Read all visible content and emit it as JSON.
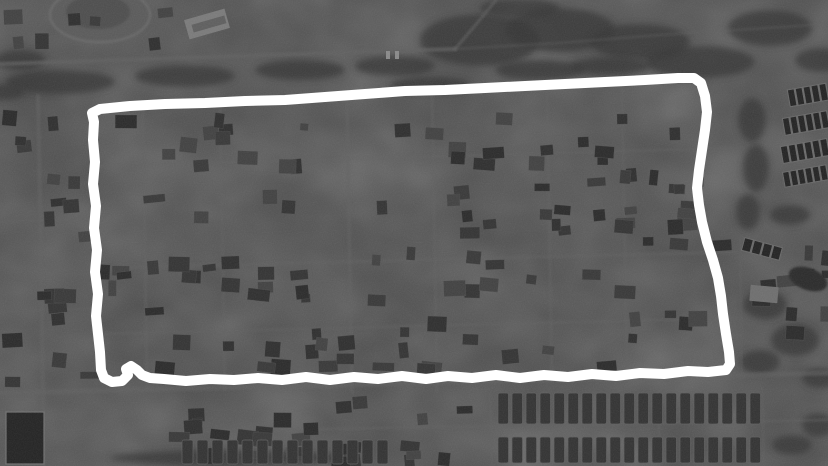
{
  "scene": {
    "kind": "grayscale-satellite-photo",
    "description": "Black-and-white aerial view of a dense low-rise residential district; a thick hand-drawn white marker outline encloses a large rectangular block of houses",
    "width": 828,
    "height": 466,
    "texture_seed": 7,
    "palette": {
      "base": "#4b4b4b",
      "ground_light": "#5a5a5a",
      "vegetation": "#363636",
      "road": "#606060",
      "building_dark": "#2e2e2e",
      "building_mid": "#383838",
      "building_light": "#6e6e6e",
      "water_dark": "#232323",
      "annotation": "#ffffff"
    }
  },
  "annotation": {
    "label": "hand-drawn-outline",
    "color": "#ffffff",
    "stroke_width": 10,
    "closed": true,
    "points": [
      [
        92,
        113
      ],
      [
        100,
        109
      ],
      [
        130,
        106
      ],
      [
        165,
        104
      ],
      [
        205,
        103
      ],
      [
        245,
        101
      ],
      [
        285,
        100
      ],
      [
        325,
        97
      ],
      [
        365,
        94
      ],
      [
        405,
        91
      ],
      [
        445,
        90
      ],
      [
        485,
        88
      ],
      [
        525,
        86
      ],
      [
        565,
        84
      ],
      [
        605,
        82
      ],
      [
        645,
        80
      ],
      [
        678,
        78
      ],
      [
        694,
        78
      ],
      [
        701,
        83
      ],
      [
        705,
        96
      ],
      [
        707,
        112
      ],
      [
        705,
        130
      ],
      [
        702,
        150
      ],
      [
        699,
        170
      ],
      [
        697,
        188
      ],
      [
        699,
        205
      ],
      [
        702,
        222
      ],
      [
        707,
        242
      ],
      [
        713,
        260
      ],
      [
        718,
        278
      ],
      [
        721,
        296
      ],
      [
        723,
        314
      ],
      [
        726,
        334
      ],
      [
        729,
        352
      ],
      [
        730,
        364
      ],
      [
        726,
        370
      ],
      [
        708,
        372
      ],
      [
        688,
        371
      ],
      [
        664,
        374
      ],
      [
        640,
        373
      ],
      [
        616,
        376
      ],
      [
        592,
        374
      ],
      [
        568,
        377
      ],
      [
        544,
        375
      ],
      [
        520,
        378
      ],
      [
        496,
        375
      ],
      [
        472,
        378
      ],
      [
        448,
        376
      ],
      [
        426,
        379
      ],
      [
        402,
        376
      ],
      [
        378,
        379
      ],
      [
        354,
        377
      ],
      [
        330,
        380
      ],
      [
        306,
        377
      ],
      [
        282,
        380
      ],
      [
        258,
        378
      ],
      [
        234,
        380
      ],
      [
        210,
        379
      ],
      [
        186,
        381
      ],
      [
        164,
        379
      ],
      [
        150,
        378
      ],
      [
        142,
        375
      ],
      [
        137,
        370
      ],
      [
        131,
        366
      ],
      [
        126,
        369
      ],
      [
        128,
        375
      ],
      [
        122,
        381
      ],
      [
        112,
        382
      ],
      [
        104,
        378
      ],
      [
        101,
        370
      ],
      [
        100,
        352
      ],
      [
        98,
        334
      ],
      [
        96,
        316
      ],
      [
        98,
        294
      ],
      [
        95,
        272
      ],
      [
        97,
        250
      ],
      [
        94,
        228
      ],
      [
        96,
        206
      ],
      [
        93,
        184
      ],
      [
        95,
        162
      ],
      [
        93,
        140
      ],
      [
        94,
        122
      ]
    ]
  },
  "features": {
    "ground_patches": [
      {
        "cx": 660,
        "cy": 16,
        "rx": 48,
        "ry": 17,
        "o": 0.55
      },
      {
        "cx": 205,
        "cy": 237,
        "rx": 46,
        "ry": 18,
        "o": 0.5
      },
      {
        "cx": 590,
        "cy": 196,
        "rx": 46,
        "ry": 20,
        "o": 0.5
      },
      {
        "cx": 470,
        "cy": 130,
        "rx": 40,
        "ry": 15,
        "o": 0.45
      },
      {
        "cx": 300,
        "cy": 310,
        "rx": 40,
        "ry": 14,
        "o": 0.45
      },
      {
        "cx": 650,
        "cy": 300,
        "rx": 35,
        "ry": 12,
        "o": 0.4
      },
      {
        "cx": 160,
        "cy": 140,
        "rx": 30,
        "ry": 10,
        "o": 0.4
      },
      {
        "cx": 520,
        "cy": 300,
        "rx": 35,
        "ry": 12,
        "o": 0.4
      },
      {
        "cx": 420,
        "cy": 222,
        "rx": 30,
        "ry": 12,
        "o": 0.4
      },
      {
        "cx": 680,
        "cy": 130,
        "rx": 30,
        "ry": 12,
        "o": 0.4
      },
      {
        "cx": 250,
        "cy": 60,
        "rx": 60,
        "ry": 10,
        "o": 0.35
      },
      {
        "cx": 790,
        "cy": 250,
        "rx": 30,
        "ry": 20,
        "o": 0.35
      }
    ],
    "oval_field": {
      "cx": 100,
      "cy": 15,
      "rx": 50,
      "ry": 27,
      "inner_rx": 32,
      "inner_ry": 17
    },
    "vegetation": [
      {
        "cx": 60,
        "cy": 82,
        "rx": 55,
        "ry": 12
      },
      {
        "cx": 185,
        "cy": 76,
        "rx": 50,
        "ry": 11
      },
      {
        "cx": 300,
        "cy": 70,
        "rx": 45,
        "ry": 10
      },
      {
        "cx": 395,
        "cy": 66,
        "rx": 40,
        "ry": 10
      },
      {
        "cx": 480,
        "cy": 40,
        "rx": 60,
        "ry": 26
      },
      {
        "cx": 560,
        "cy": 30,
        "rx": 55,
        "ry": 22
      },
      {
        "cx": 640,
        "cy": 42,
        "rx": 50,
        "ry": 18
      },
      {
        "cx": 700,
        "cy": 62,
        "rx": 55,
        "ry": 16
      },
      {
        "cx": 770,
        "cy": 28,
        "rx": 42,
        "ry": 18
      },
      {
        "cx": 820,
        "cy": 60,
        "rx": 25,
        "ry": 12
      },
      {
        "cx": 430,
        "cy": 85,
        "rx": 40,
        "ry": 8
      },
      {
        "cx": 540,
        "cy": 70,
        "rx": 45,
        "ry": 10
      },
      {
        "cx": 610,
        "cy": 66,
        "rx": 40,
        "ry": 9
      },
      {
        "cx": 752,
        "cy": 120,
        "rx": 14,
        "ry": 22
      },
      {
        "cx": 756,
        "cy": 168,
        "rx": 13,
        "ry": 24
      },
      {
        "cx": 748,
        "cy": 212,
        "rx": 12,
        "ry": 18
      },
      {
        "cx": 790,
        "cy": 215,
        "rx": 20,
        "ry": 10
      },
      {
        "cx": 765,
        "cy": 305,
        "rx": 22,
        "ry": 14
      },
      {
        "cx": 795,
        "cy": 340,
        "rx": 24,
        "ry": 16
      },
      {
        "cx": 760,
        "cy": 362,
        "rx": 20,
        "ry": 12
      },
      {
        "cx": 820,
        "cy": 378,
        "rx": 18,
        "ry": 10
      },
      {
        "cx": 20,
        "cy": 60,
        "rx": 25,
        "ry": 10
      },
      {
        "cx": 5,
        "cy": 92,
        "rx": 20,
        "ry": 8
      },
      {
        "cx": 818,
        "cy": 425,
        "rx": 16,
        "ry": 12
      },
      {
        "cx": 792,
        "cy": 445,
        "rx": 20,
        "ry": 10
      },
      {
        "cx": 230,
        "cy": 458,
        "rx": 120,
        "ry": 8
      },
      {
        "cx": 520,
        "cy": 8,
        "rx": 40,
        "ry": 10
      }
    ],
    "roads": [
      {
        "pts": [
          [
            0,
            64
          ],
          [
            120,
            60
          ],
          [
            240,
            56
          ],
          [
            360,
            52
          ],
          [
            455,
            49
          ]
        ],
        "w": 4,
        "o": 0.7
      },
      {
        "pts": [
          [
            455,
            49
          ],
          [
            478,
            22
          ],
          [
            496,
            0
          ]
        ],
        "w": 3,
        "o": 0.6
      },
      {
        "pts": [
          [
            455,
            49
          ],
          [
            560,
            43
          ],
          [
            660,
            35
          ],
          [
            828,
            24
          ]
        ],
        "w": 3,
        "o": 0.3
      },
      {
        "pts": [
          [
            38,
            96
          ],
          [
            41,
            250
          ],
          [
            44,
            466
          ]
        ],
        "w": 4,
        "o": 0.55
      },
      {
        "pts": [
          [
            143,
            112
          ],
          [
            147,
            388
          ]
        ],
        "w": 3,
        "o": 0.45
      },
      {
        "pts": [
          [
            220,
            110
          ],
          [
            225,
            390
          ]
        ],
        "w": 3,
        "o": 0.4
      },
      {
        "pts": [
          [
            347,
            100
          ],
          [
            352,
            392
          ]
        ],
        "w": 3.5,
        "o": 0.5
      },
      {
        "pts": [
          [
            432,
            96
          ],
          [
            437,
            392
          ]
        ],
        "w": 3,
        "o": 0.45
      },
      {
        "pts": [
          [
            547,
            88
          ],
          [
            552,
            382
          ]
        ],
        "w": 3,
        "o": 0.45
      },
      {
        "pts": [
          [
            622,
            84
          ],
          [
            627,
            380
          ]
        ],
        "w": 3,
        "o": 0.4
      },
      {
        "pts": [
          [
            100,
            166
          ],
          [
            732,
            148
          ]
        ],
        "w": 3,
        "o": 0.4
      },
      {
        "pts": [
          [
            100,
            268
          ],
          [
            736,
            252
          ]
        ],
        "w": 3.5,
        "o": 0.45
      },
      {
        "pts": [
          [
            100,
            334
          ],
          [
            736,
            318
          ]
        ],
        "w": 3,
        "o": 0.4
      },
      {
        "pts": [
          [
            0,
            393
          ],
          [
            828,
            373
          ]
        ],
        "w": 5,
        "o": 0.55
      },
      {
        "pts": [
          [
            150,
            432
          ],
          [
            828,
            420
          ]
        ],
        "w": 3,
        "o": 0.45
      },
      {
        "pts": [
          [
            740,
            238
          ],
          [
            742,
            380
          ]
        ],
        "w": 3,
        "o": 0.3
      },
      {
        "pts": [
          [
            490,
            394
          ],
          [
            492,
            466
          ]
        ],
        "w": 3,
        "o": 0.4
      },
      {
        "pts": [
          [
            658,
            390
          ],
          [
            660,
            466
          ]
        ],
        "w": 3,
        "o": 0.4
      },
      {
        "pts": [
          [
            762,
            388
          ],
          [
            764,
            466
          ]
        ],
        "w": 3,
        "o": 0.35
      },
      {
        "pts": [
          [
            0,
            222
          ],
          [
            95,
            218
          ]
        ],
        "w": 3,
        "o": 0.35
      },
      {
        "pts": [
          [
            0,
            312
          ],
          [
            95,
            308
          ]
        ],
        "w": 3,
        "o": 0.3
      }
    ],
    "building_regions": [
      {
        "x": 108,
        "y": 112,
        "w": 615,
        "h": 48,
        "count": 26
      },
      {
        "x": 108,
        "y": 168,
        "w": 615,
        "h": 60,
        "count": 30
      },
      {
        "x": 108,
        "y": 236,
        "w": 620,
        "h": 62,
        "count": 30
      },
      {
        "x": 108,
        "y": 306,
        "w": 622,
        "h": 60,
        "count": 28
      },
      {
        "x": 2,
        "y": 100,
        "w": 90,
        "h": 285,
        "count": 20
      },
      {
        "x": 150,
        "y": 396,
        "w": 330,
        "h": 62,
        "count": 26
      },
      {
        "x": 745,
        "y": 230,
        "w": 78,
        "h": 148,
        "count": 10
      },
      {
        "x": 0,
        "y": 4,
        "w": 170,
        "h": 46,
        "count": 7
      }
    ],
    "house_rows": [
      {
        "x": 498,
        "y": 393,
        "count": 19,
        "w": 10.5,
        "h": 31,
        "gap": 3.5
      },
      {
        "x": 498,
        "y": 437,
        "count": 19,
        "w": 10.5,
        "h": 26,
        "gap": 3.5
      },
      {
        "x": 182,
        "y": 440,
        "count": 14,
        "w": 11,
        "h": 24,
        "gap": 4
      }
    ],
    "barracks_rows": [
      {
        "x": 788,
        "y": 86,
        "w": 40,
        "h": 18,
        "rot": -10,
        "stripes": 5
      },
      {
        "x": 783,
        "y": 114,
        "w": 46,
        "h": 18,
        "rot": -10,
        "stripes": 6
      },
      {
        "x": 781,
        "y": 142,
        "w": 48,
        "h": 18,
        "rot": -10,
        "stripes": 6
      },
      {
        "x": 783,
        "y": 168,
        "w": 45,
        "h": 16,
        "rot": -10,
        "stripes": 6
      },
      {
        "x": 742,
        "y": 242,
        "w": 40,
        "h": 14,
        "rot": 15,
        "stripes": 4
      }
    ],
    "special_buildings": [
      {
        "x": 186,
        "y": 14,
        "w": 42,
        "h": 20,
        "rot": -16,
        "fill": "#7a7a7a"
      },
      {
        "x": 192,
        "y": 20,
        "w": 34,
        "h": 8,
        "rot": -16,
        "fill": "#5e5e5e"
      },
      {
        "x": 750,
        "y": 286,
        "w": 28,
        "h": 16,
        "rot": 5,
        "fill": "#6e6e6e"
      },
      {
        "x": 386,
        "y": 51,
        "w": 4,
        "h": 8,
        "rot": 0,
        "fill": "#8a8a8a"
      },
      {
        "x": 395,
        "y": 51,
        "w": 4,
        "h": 8,
        "rot": 0,
        "fill": "#8a8a8a"
      }
    ],
    "ponds": [
      {
        "type": "rect",
        "x": 6,
        "y": 412,
        "w": 38,
        "h": 52
      },
      {
        "type": "ellipse",
        "cx": 808,
        "cy": 279,
        "rx": 20,
        "ry": 11,
        "rot": 20
      }
    ]
  }
}
